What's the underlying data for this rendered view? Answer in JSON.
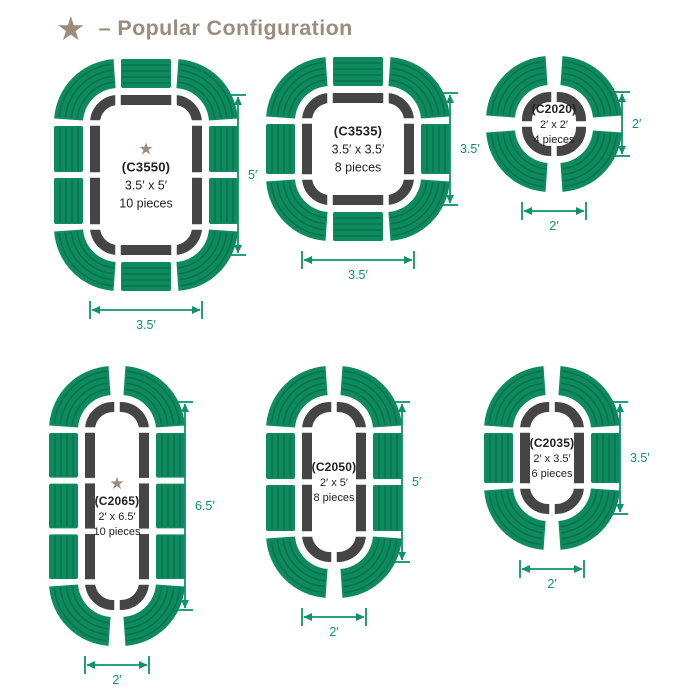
{
  "header": {
    "star_glyph": "★",
    "title": "– Popular Configuration"
  },
  "colors": {
    "piece_green": "#0d8a5e",
    "piece_stripe": "rgba(0,0,0,0.16)",
    "track_gray": "#454545",
    "gap_white": "#ffffff",
    "dimension_green": "#0f9269",
    "accent_brown": "#9d8c7c",
    "text_dark": "#212121",
    "background": "#ffffff"
  },
  "configs": [
    {
      "id": "C3550",
      "model": "(C3550)",
      "size": "3.5′ x 5′",
      "pieces": "10 pieces",
      "popular": true,
      "width_ft": 3.5,
      "height_ft": 5,
      "width_label": "3.5′",
      "height_label": "5′",
      "sides": {
        "top": 1,
        "bottom": 1,
        "left": 2,
        "right": 2
      }
    },
    {
      "id": "C3535",
      "model": "(C3535)",
      "size": "3.5′ x 3.5′",
      "pieces": "8 pieces",
      "popular": false,
      "width_ft": 3.5,
      "height_ft": 3.5,
      "width_label": "3.5′",
      "height_label": "3.5′",
      "sides": {
        "top": 1,
        "bottom": 1,
        "left": 1,
        "right": 1
      }
    },
    {
      "id": "C2020",
      "model": "(C2020)",
      "size": "2′ x 2′",
      "pieces": "4 pieces",
      "popular": false,
      "width_ft": 2,
      "height_ft": 2,
      "width_label": "2′",
      "height_label": "2′",
      "sides": {
        "top": 0,
        "bottom": 0,
        "left": 0,
        "right": 0
      }
    },
    {
      "id": "C2065",
      "model": "(C2065)",
      "size": "2′ x 6.5′",
      "pieces": "10 pieces",
      "popular": true,
      "width_ft": 2,
      "height_ft": 6.5,
      "width_label": "2′",
      "height_label": "6.5′",
      "sides": {
        "top": 0,
        "bottom": 0,
        "left": 3,
        "right": 3
      }
    },
    {
      "id": "C2050",
      "model": "(C2050)",
      "size": "2′ x 5′",
      "pieces": "8 pieces",
      "popular": false,
      "width_ft": 2,
      "height_ft": 5,
      "width_label": "2′",
      "height_label": "5′",
      "sides": {
        "top": 0,
        "bottom": 0,
        "left": 2,
        "right": 2
      }
    },
    {
      "id": "C2035",
      "model": "(C2035)",
      "size": "2′ x 3.5′",
      "pieces": "6 pieces",
      "popular": false,
      "width_ft": 2,
      "height_ft": 3.5,
      "width_label": "2′",
      "height_label": "3.5′",
      "sides": {
        "top": 0,
        "bottom": 0,
        "left": 1,
        "right": 1
      }
    }
  ]
}
